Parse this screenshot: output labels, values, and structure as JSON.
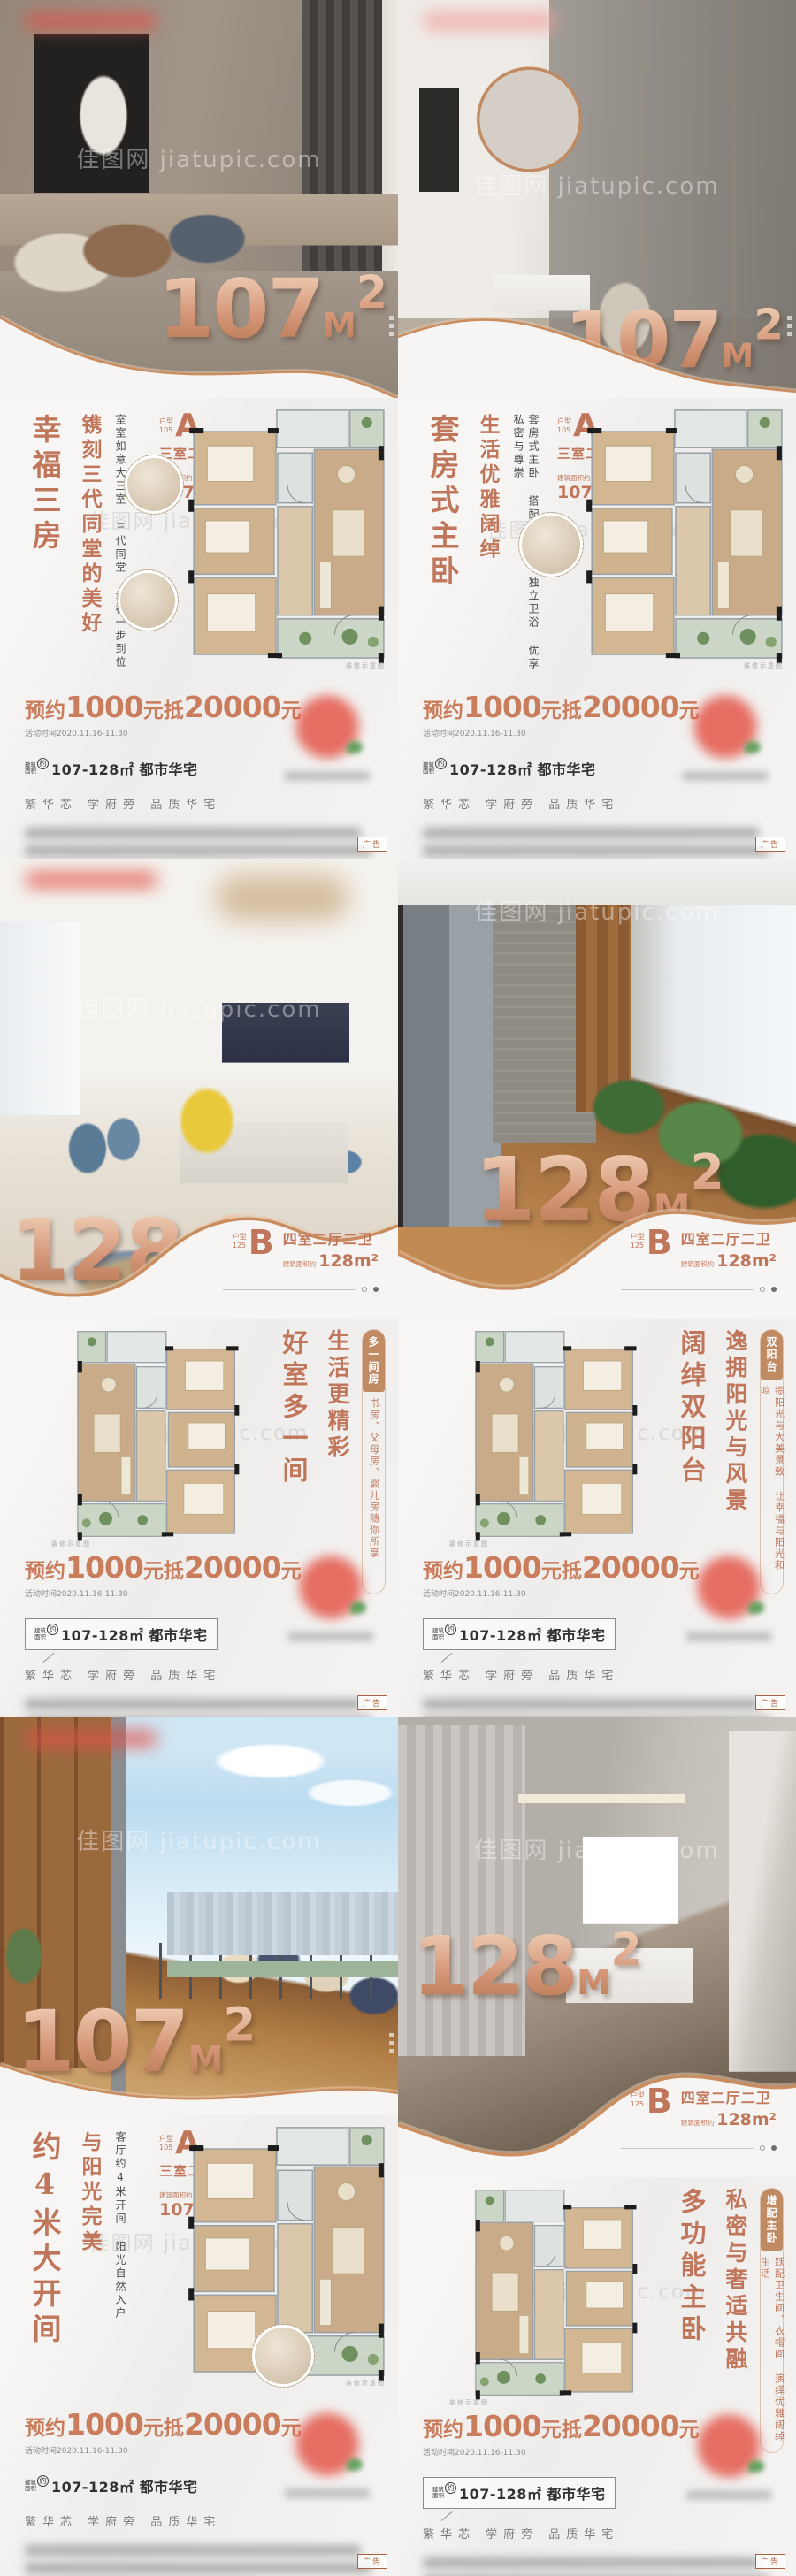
{
  "watermark": {
    "line": "佳图网 jiatupic.com"
  },
  "shared": {
    "price": {
      "prefix": "预约",
      "amount1": "1000",
      "middle": "元抵",
      "amount2": "20000",
      "suffix": "元"
    },
    "price_note": "活动时间2020.11.16-11.30",
    "range": {
      "tag_line1": "建筑",
      "tag_line2": "面积",
      "tag_circle": "约",
      "text": "107-128㎡ 都市华宅"
    },
    "slogan": "繁华芯  学府旁  品质华宅",
    "ad_badge": "广告",
    "plan_caption": "装修示意图",
    "unit_label": "户型",
    "area_label": "建筑面积约"
  },
  "panels": [
    {
      "area": "107",
      "unit_m": "M",
      "unit_sup": "2",
      "block": "105",
      "letter": "A",
      "rooms": "三室二厅二卫",
      "area_value": "107m²",
      "headline_primary": "幸福三房",
      "headline_secondary": "镌刻三代同堂的美好",
      "headline_detail": "室室如意大三室  三代同堂  幸福一步到位"
    },
    {
      "area": "107",
      "unit_m": "M",
      "unit_sup": "2",
      "block": "105",
      "letter": "A",
      "rooms": "三室二厅二卫",
      "area_value": "107m²",
      "headline_primary": "套房式主卧",
      "headline_secondary": "生活优雅阔绰",
      "headline_detail": "套房式主卧  搭配衣帽间  独立卫浴  优享私密与尊崇"
    },
    {
      "area": "128",
      "unit_m": "M",
      "unit_sup": "2",
      "block": "125",
      "letter": "B",
      "rooms": "四室二厅二卫",
      "area_value": "128m²",
      "headline_primary": "好室多一间",
      "headline_secondary": "生活更精彩",
      "tag_title": "多一间房",
      "tag_body": "书房、父母房、婴儿房随你所享"
    },
    {
      "area": "128",
      "unit_m": "M",
      "unit_sup": "2",
      "block": "125",
      "letter": "B",
      "rooms": "四室二厅二卫",
      "area_value": "128m²",
      "headline_primary": "阔绰双阳台",
      "headline_secondary": "逸拥阳光与风景",
      "tag_title": "双阳台",
      "tag_body": "揽阳光与大美景致  让幸福与阳光和鸣"
    },
    {
      "area": "107",
      "unit_m": "M",
      "unit_sup": "2",
      "block": "105",
      "letter": "A",
      "rooms": "三室二厅二卫",
      "area_value": "107m²",
      "headline_primary": "约4米大开间",
      "headline_secondary": "与阳光完美",
      "headline_detail": "客厅约4米开间  阳光自然入户"
    },
    {
      "area": "128",
      "unit_m": "M",
      "unit_sup": "2",
      "block": "125",
      "letter": "B",
      "rooms": "四室二厅二卫",
      "area_value": "128m²",
      "headline_primary": "多功能主卧",
      "headline_secondary": "私密与奢适共融",
      "tag_title": "增配主卧",
      "tag_body": "跃配卫生间、衣帽间  演绎优雅阔绰生活"
    }
  ]
}
